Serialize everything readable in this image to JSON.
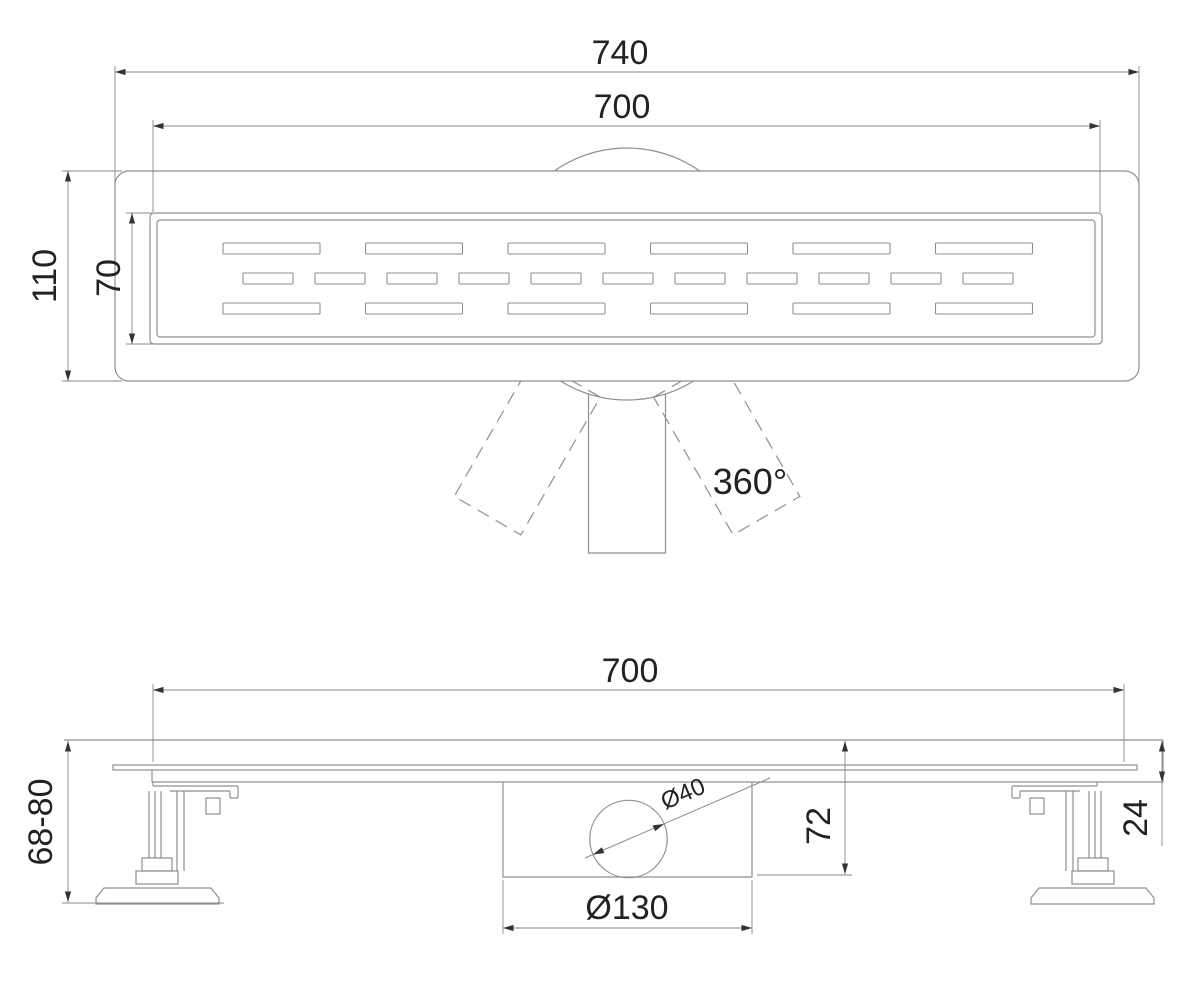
{
  "title": "Linear shower drain technical drawing",
  "labels": {
    "top_view": {
      "overall_length": "740",
      "grate_length": "700",
      "overall_width": "110",
      "grate_width": "70",
      "rotation": "360°"
    },
    "side_view": {
      "grate_length": "700",
      "install_height": "68-80",
      "outlet_diameter": "Ø40",
      "trap_height": "72",
      "trap_diameter": "Ø130",
      "rim_height": "24"
    }
  },
  "grate": {
    "slot_corner_radius": 1,
    "rows": [
      {
        "y": 243,
        "height": 11,
        "count": 6,
        "start_x": 223,
        "slot_width": 97,
        "pitch": 142.5
      },
      {
        "y": 273,
        "height": 11,
        "count": 11,
        "start_x": 243,
        "slot_width": 50,
        "pitch": 72
      },
      {
        "y": 303,
        "height": 11,
        "count": 6,
        "start_x": 223,
        "slot_width": 97,
        "pitch": 142.5
      }
    ]
  },
  "colors": {
    "line": "#8f8f8f",
    "dim": "#8a8a8a",
    "arrow": "#333333",
    "text": "#222222",
    "background": "#ffffff"
  }
}
